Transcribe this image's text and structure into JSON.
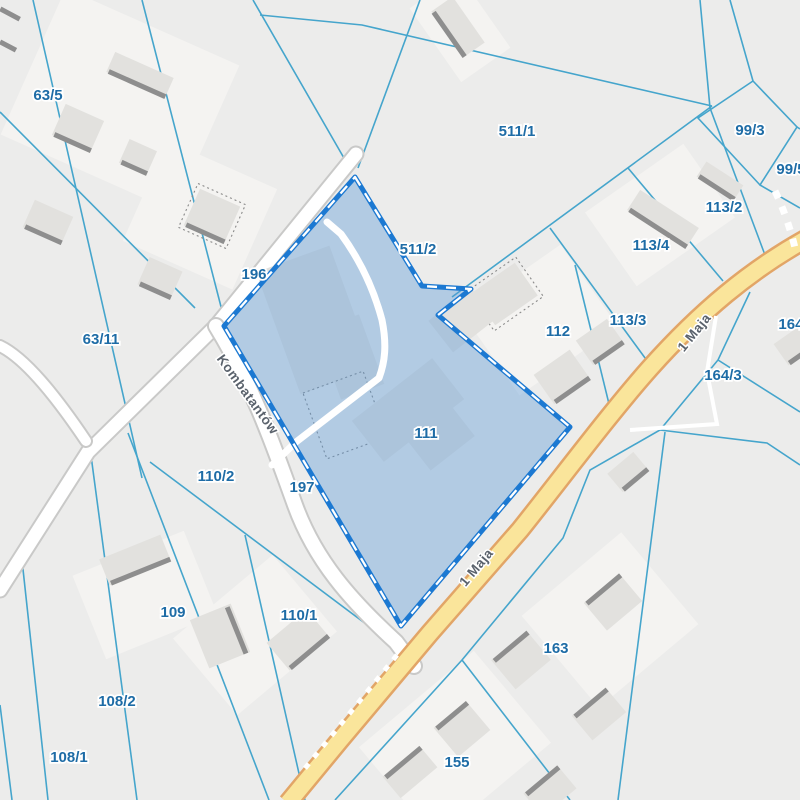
{
  "map": {
    "highlighted_parcel": "111",
    "parcel_labels": [
      {
        "text": "63/5",
        "x": 48,
        "y": 96
      },
      {
        "text": "63/11",
        "x": 101,
        "y": 340
      },
      {
        "text": "196",
        "x": 254,
        "y": 275
      },
      {
        "text": "197",
        "x": 302,
        "y": 488
      },
      {
        "text": "511/1",
        "x": 517,
        "y": 132
      },
      {
        "text": "511/2",
        "x": 418,
        "y": 250
      },
      {
        "text": "99/3",
        "x": 750,
        "y": 131
      },
      {
        "text": "99/5",
        "x": 791,
        "y": 170
      },
      {
        "text": "113/2",
        "x": 724,
        "y": 208
      },
      {
        "text": "113/4",
        "x": 651,
        "y": 246
      },
      {
        "text": "113/3",
        "x": 628,
        "y": 321
      },
      {
        "text": "112",
        "x": 558,
        "y": 332
      },
      {
        "text": "164/",
        "x": 793,
        "y": 325
      },
      {
        "text": "164/3",
        "x": 723,
        "y": 376
      },
      {
        "text": "111",
        "x": 426,
        "y": 434
      },
      {
        "text": "110/2",
        "x": 216,
        "y": 477
      },
      {
        "text": "109",
        "x": 173,
        "y": 613
      },
      {
        "text": "110/1",
        "x": 299,
        "y": 616
      },
      {
        "text": "108/2",
        "x": 117,
        "y": 702
      },
      {
        "text": "108/1",
        "x": 69,
        "y": 758
      },
      {
        "text": "163",
        "x": 556,
        "y": 649
      },
      {
        "text": "155",
        "x": 457,
        "y": 763
      }
    ],
    "street_labels": [
      {
        "text": "Kombatantów",
        "x": 247,
        "y": 395,
        "rot": 54
      },
      {
        "text": "1 Maja",
        "x": 695,
        "y": 333,
        "rot": -51
      },
      {
        "text": "1 Maja",
        "x": 477,
        "y": 568,
        "rot": -50
      }
    ],
    "colors": {
      "background": "#ececeb",
      "parcel_line": "#45a5cc",
      "parcel_label": "#1e6ca6",
      "street_label": "#5a626c",
      "road_fill": "#fae59b",
      "road_casing": "#e2a567",
      "street_fill": "#ffffff",
      "street_casing": "#c9c9c8",
      "building": "#e2e1de",
      "building_shadow": "#8e8e8e",
      "highlight_fill": "rgba(85,150,215,0.38)",
      "highlight_border": "#1c79d2",
      "highlight_dash": "#ffffff"
    }
  }
}
